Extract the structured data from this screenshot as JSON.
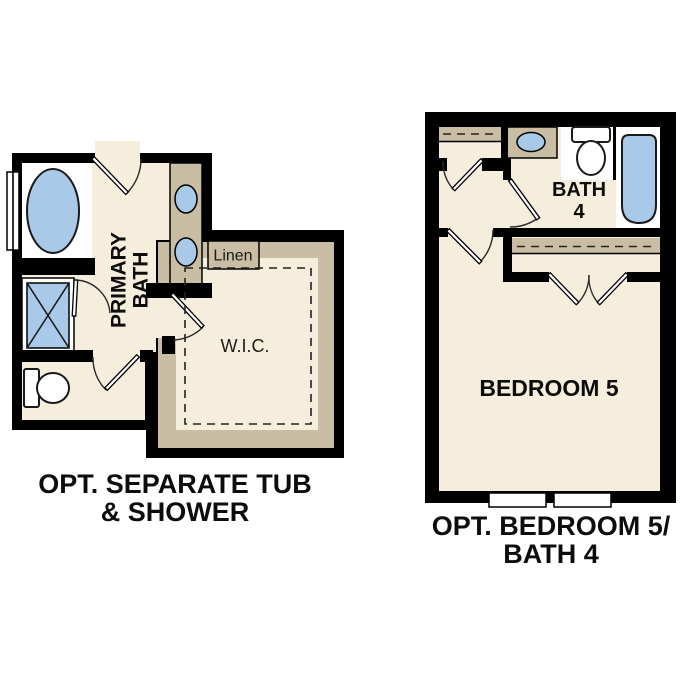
{
  "page": {
    "background": "#ffffff"
  },
  "palette": {
    "wall_black": "#000000",
    "floor_cream": "#f6eedd",
    "cabinet_tan": "#c9bda4",
    "fixture_blue": "#a9c9e8",
    "fixture_white": "#ffffff",
    "text_dark": "#0d0d0d"
  },
  "plan_left": {
    "caption": {
      "line1": "OPT. SEPARATE TUB",
      "line2": "& SHOWER"
    },
    "labels": {
      "primary_bath_line1": "PRIMARY",
      "primary_bath_line2": "BATH",
      "wic": "W.I.C.",
      "linen": "Linen"
    },
    "fixtures": [
      "bathtub",
      "shower",
      "toilet",
      "double-sink-vanity",
      "window",
      "doors"
    ]
  },
  "plan_right": {
    "caption": {
      "line1": "OPT. BEDROOM 5/",
      "line2": "BATH 4"
    },
    "labels": {
      "bath_line1": "BATH",
      "bath_line2": "4",
      "bedroom": "BEDROOM 5"
    },
    "fixtures": [
      "bathtub",
      "toilet",
      "sink-vanity",
      "closets",
      "windows",
      "doors"
    ]
  }
}
